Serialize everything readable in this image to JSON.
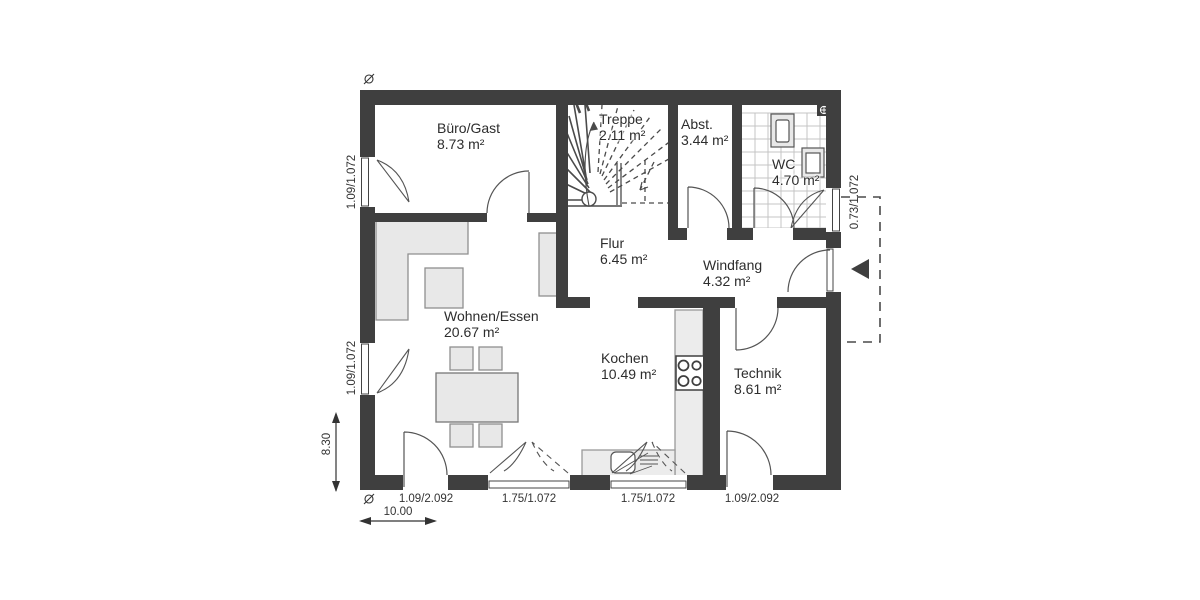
{
  "plan_type": "floorplan-ground-floor",
  "rooms": {
    "buero": {
      "name": "Büro/Gast",
      "area": "8.73 m²"
    },
    "treppe": {
      "name": "Treppe",
      "area": "2.11 m²"
    },
    "abstell": {
      "name": "Abst.",
      "area": "3.44 m²"
    },
    "wc": {
      "name": "WC",
      "area": "4.70 m²"
    },
    "flur": {
      "name": "Flur",
      "area": "6.45 m²"
    },
    "windfang": {
      "name": "Windfang",
      "area": "4.32 m²"
    },
    "wohnen": {
      "name": "Wohnen/Essen",
      "area": "20.67 m²"
    },
    "kochen": {
      "name": "Kochen",
      "area": "10.49 m²"
    },
    "technik": {
      "name": "Technik",
      "area": "8.61 m²"
    }
  },
  "dimensions": {
    "window_left_upper": "1.09/1.072",
    "window_left_lower": "1.09/1.072",
    "window_wc": "0.73/1.072",
    "door_south_west": "1.09/2.092",
    "window_south_1": "1.75/1.072",
    "window_south_2": "1.75/1.072",
    "door_south_east": "1.09/2.092",
    "building_depth": "8.30",
    "building_width": "10.00"
  },
  "colors": {
    "wall": "#3f3f3f",
    "furniture_fill": "#e8e8e8",
    "counter_fill": "#ececec",
    "line": "#4a4a4a",
    "tile_line": "#c4c4c4",
    "text": "#2d2d2d"
  }
}
